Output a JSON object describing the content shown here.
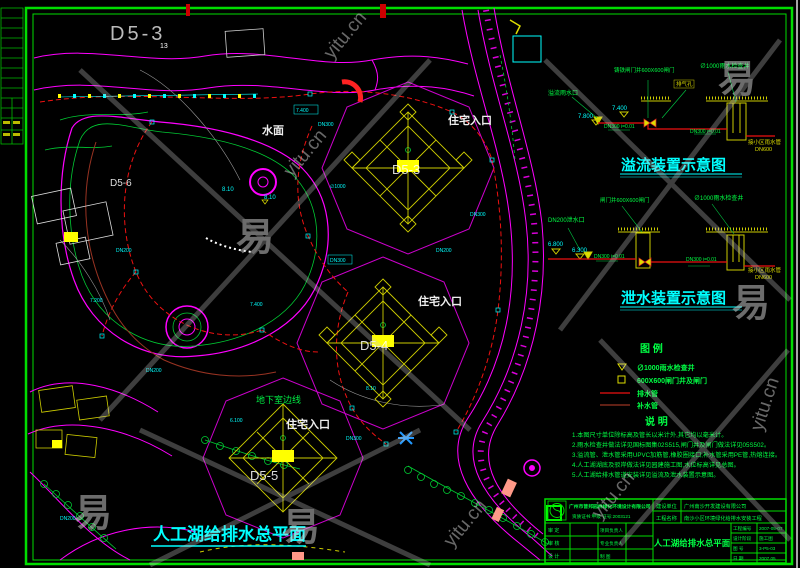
{
  "wm": {
    "glyph": "易",
    "site": "yitu.cn"
  },
  "plan": {
    "area_label": "D5-3",
    "water": "水面",
    "entrance": "住宅入口",
    "basement_edge": "地下室边线",
    "b1": "D5-3",
    "b2": "D5-4",
    "b3": "D5-5",
    "b4": "D5-6",
    "n13": "13",
    "elev": "8.10",
    "title": "人工湖给排水总平面",
    "micro": [
      "7.400",
      "DN300",
      "∅1000",
      "DN200",
      "DN300",
      "7.400",
      "DN200",
      "6.100",
      "DN300",
      "7.200",
      "DN200",
      "8.10",
      "DN300",
      "DN200"
    ]
  },
  "overflow": {
    "title": "溢流装置示意图",
    "inlet": "溢流雨水口",
    "gate": "铸铁闸门井600X600闸门",
    "vent": "排气孔",
    "well": "∅1000雨水检查井",
    "pipe": "DN300 i=0.01",
    "outlet1": "接小区雨水管",
    "outlet2": "DN600",
    "lv1": "7.400",
    "lv2": "7.800"
  },
  "drain": {
    "title": "泄水装置示意图",
    "inlet": "DN200泄水口",
    "gate": "闸门井600X600闸门",
    "well": "∅1000雨水检查井",
    "pipe": "DN300 i=0.01",
    "outlet1": "接小区雨水管",
    "outlet2": "DN600",
    "lv1": "6.800",
    "lv2": "6.300"
  },
  "legend": {
    "heading": "图    例",
    "items": [
      {
        "t": "∅1000雨水检查井"
      },
      {
        "t": "600X600闸门井及闸门"
      },
      {
        "t": "排水管"
      },
      {
        "t": "补水管"
      }
    ]
  },
  "notes": {
    "heading": "说    明",
    "lines": [
      "1.本图尺寸单位除标高及管长以米计外,其它均以毫米计。",
      "2.雨水检查井做法详见国标图集02S515,闸门井及闸门做法详见05S502。",
      "3.溢流管、泄水管采用UPVC加筋管,橡胶圈接口;补水管采用PE管,热熔连接。",
      "4.人工湖湖底及驳岸做法详见园建施工图,水位标高详见总图。",
      "5.人工湖给排水管道安装详见溢流及泄水装置示意图。"
    ]
  },
  "tb": {
    "company": "广州市普邦园林绿化环境设计有限公司",
    "cert": "资质证书:甲级  证号:2003121",
    "owner_label": "建设单位",
    "owner": "广州南沙开发建设有限公司",
    "project_label": "工程名称",
    "project": "南沙小区环境绿化给排水安装工程",
    "title": "人工湖给排水总平面",
    "p1a": "审 定",
    "p1b": "项目负责人",
    "p2a": "审 核",
    "p2b": "专业负责人",
    "p3a": "设 计",
    "p3b": "制 图",
    "f1l": "工程编号",
    "f1v": "2007-05-07",
    "f2l": "设计阶段",
    "f2v": "施工图",
    "f3l": "图 号",
    "f3v": "3-P5-03",
    "f4l": "日 期",
    "f4v": "2007.05"
  }
}
